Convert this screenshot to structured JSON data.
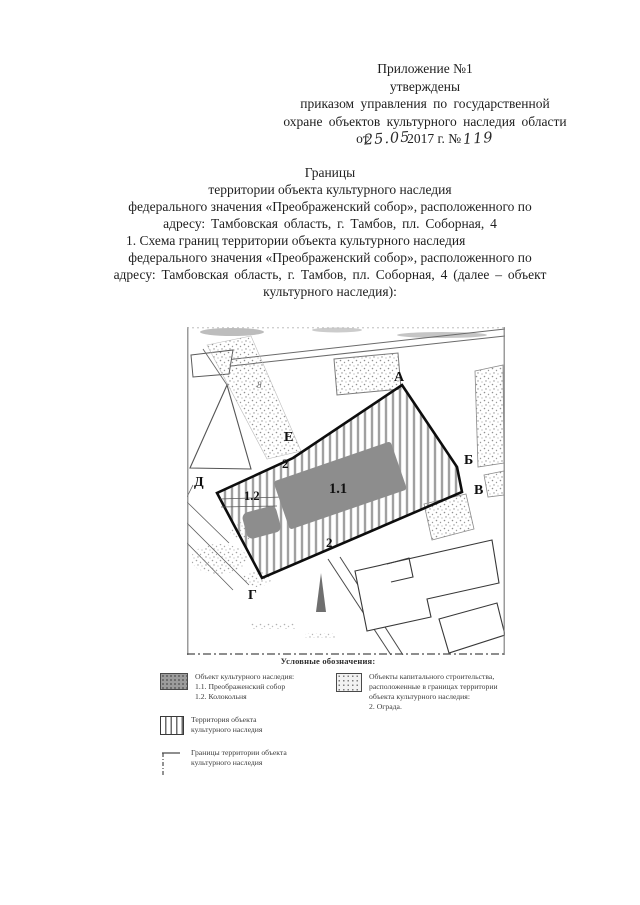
{
  "header": {
    "appendix": "Приложение №1",
    "approved": "утверждены",
    "order_line1": "приказом  управления  по государственной",
    "order_line2": "охране  объектов культурного  наследия   области",
    "date_prefix": "от",
    "date_hand": "25.05",
    "date_year": "2017 г.",
    "number_sign": "№",
    "number_hand": "119"
  },
  "title": {
    "line1": "Границы",
    "line2": "территории объекта культурного наследия",
    "line3": "федерального значения «Преображенский собор», расположенного по",
    "line4": "адресу: Тамбовская область, г. Тамбов, пл. Соборная, 4",
    "line5": "1. Схема границ территории объекта культурного наследия",
    "line6": "федерального значения «Преображенский собор», расположенного по",
    "line7": "адресу: Тамбовская область, г. Тамбов, пл. Соборная, 4 (далее – объект",
    "line8": "культурного наследия):"
  },
  "map": {
    "points": {
      "a": "А",
      "b": "Б",
      "v": "В",
      "g": "Г",
      "d": "Д",
      "e": "Е"
    },
    "labels": {
      "cathedral": "1.1",
      "bell_tower": "1.2",
      "fence_top": "2",
      "fence_bottom": "2",
      "house": "8"
    }
  },
  "legend": {
    "heading": "Условные обозначения:",
    "object": {
      "line1": "Объект культурного наследия:",
      "line2": "1.1. Преображенский собор",
      "line3": "1.2. Колокольня"
    },
    "territory": {
      "line1": "Территория объекта",
      "line2": "культурного наследия"
    },
    "boundary": {
      "line1": "Границы территории объекта",
      "line2": "культурного наследия"
    },
    "capital": {
      "line1": "Объекты капитального строительства,",
      "line2": "расположенные в границах территории",
      "line3": "объекта культурного наследия:",
      "line4": "2. Ограда."
    }
  }
}
